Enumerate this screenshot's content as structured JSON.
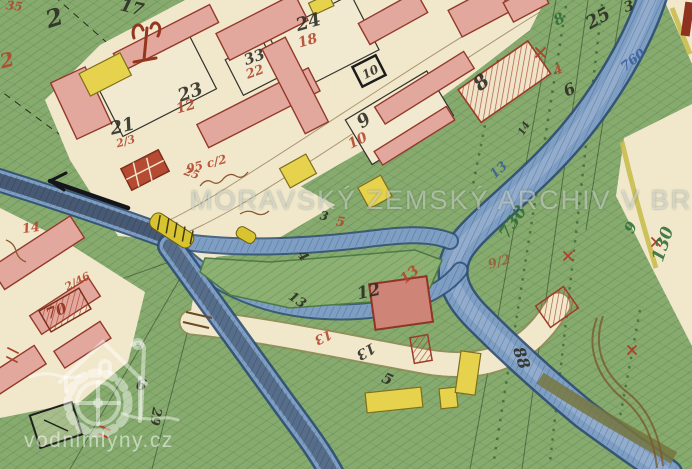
{
  "watermark": {
    "archive_text": "MORAVSKÝ ZEMSKÝ ARCHIV V BR",
    "site_text": "vodnimlyny.cz",
    "logo_name": "water-mill-house-logo"
  },
  "palette": {
    "field_green": "#87ab6e",
    "road_beige": "#f1e8cc",
    "river_blue": "#7e9ec3",
    "river_edge": "#2d4d75",
    "building_pink": "#e3a89d",
    "building_yellow": "#e6d24c",
    "roof_red": "#9c3d2a",
    "weir_yellow": "#d8c430",
    "ink_black": "#2a2a22",
    "ink_red": "#b2452c",
    "ink_green": "#2f6e36",
    "ink_blue": "#3a5f9c"
  },
  "labels": {
    "black": {
      "n17": "17",
      "n2": "2",
      "n23": "23",
      "n21": "21",
      "n24": "24",
      "n33": "33",
      "n10_box": "10",
      "n9": "9",
      "n25": "25",
      "n3_top": "3",
      "n8": "8",
      "n6": "6",
      "n14": "14",
      "n3_mid": "3",
      "n4_island": "4",
      "n13_island": "13",
      "n12": "12",
      "n13_road": "13",
      "n88": "88",
      "n5_script": "5",
      "n29": "29",
      "n6_script": "6"
    },
    "red": {
      "n12": "12",
      "n18": "18",
      "n22": "22",
      "n2_3": "2/3",
      "n10": "10",
      "n95c2": "95 c/2",
      "n14": "14",
      "n25": "25",
      "n2_46": "2/46",
      "n5": "5",
      "n13_a": "13",
      "n13_b": "13",
      "n4": "4",
      "n35": "35",
      "n2_script": "2"
    },
    "darkred": {
      "n70": "70"
    },
    "green": {
      "n8": "8",
      "n730": "730",
      "n130": "130",
      "n9": "9"
    },
    "blue": {
      "n760": "760",
      "n13": "13"
    },
    "brown": {
      "n9_2": "9/2"
    }
  }
}
